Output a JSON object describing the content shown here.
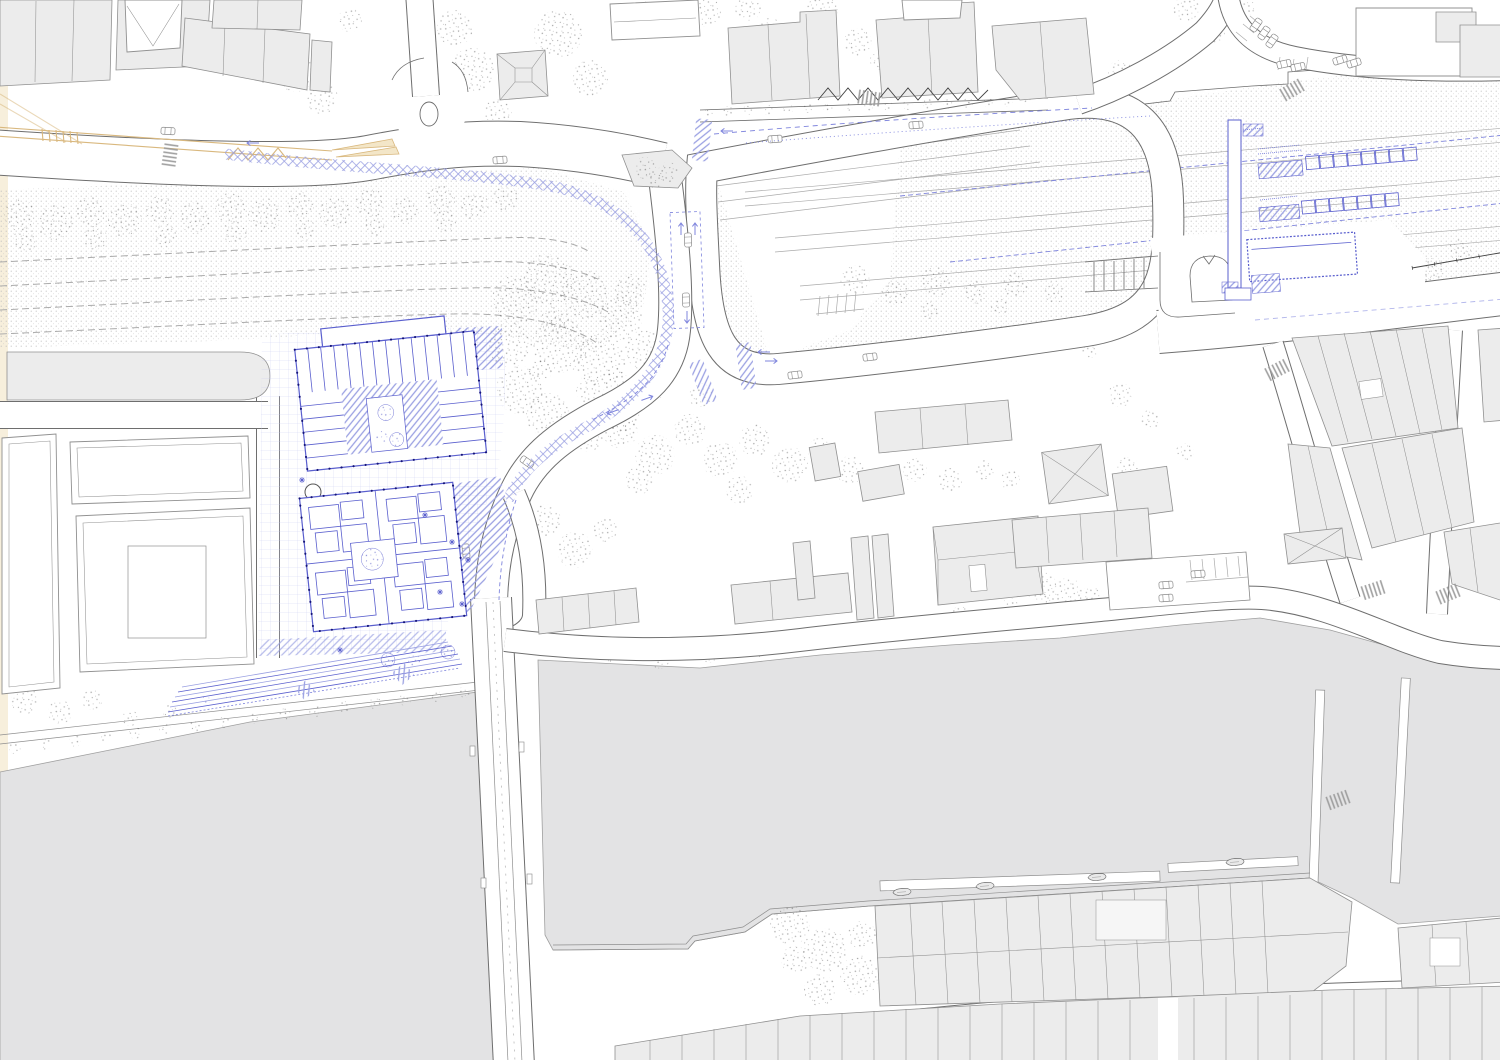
{
  "canvas": {
    "width": 1500,
    "height": 1060
  },
  "drawing": {
    "kind": "architectural site plan / urban masterplan",
    "view": "top-down technical plan drawing",
    "visible_text": "none"
  },
  "palette": {
    "paper": "#ffffff",
    "margin": "#f7efdc",
    "water": "#e3e3e4",
    "waterLine": "#9f9f9f",
    "bldgFill": "#ececec",
    "bldgLight": "#f5f5f5",
    "bldgLine": "#909090",
    "roadLine": "#6e6e6e",
    "railDot": "#bcbcbc",
    "trackLine": "#ababab",
    "treeInk": "#555555",
    "blueLine": "#5a5fce",
    "blueDark": "#15157a",
    "blueHatch": "#9aa0e2",
    "blueGrid": "#c9ccf0",
    "blueDash": "#7f85dd",
    "tan": "#d9b87e",
    "tanFill": "#f3e6c8",
    "carLine": "#8a8a8a",
    "darkLine": "#444444"
  },
  "features": {
    "water_bodies": {
      "count": 2,
      "names": [
        "river-west-basin",
        "river-east-basin"
      ],
      "color_key": "water"
    },
    "bridge": {
      "name": "road-bridge-over-river",
      "orientation": "north-south"
    },
    "railway_corridor": {
      "texture": "stipple-dots",
      "tracks_west": 4,
      "platform_lines_east": 6,
      "color_key": "railDot"
    },
    "roads": {
      "style": "white-with-gray-casing",
      "includes": [
        "top-boulevard",
        "rail-loop-ring",
        "east-station-road",
        "junction-connector",
        "bridge-street",
        "riverside-road",
        "old-town-diagonal",
        "old-town-vertical",
        "bottom-right-street",
        "northeast-branch",
        "top-right-road",
        "plaza-fork-road",
        "west-service-street",
        "west-cross-street"
      ]
    },
    "roundabout": {
      "island": "oval"
    },
    "existing_buildings": {
      "color_key": "bldgFill",
      "areas": [
        "top-left-block",
        "top-center-row",
        "left-courtyard-blocks",
        "mid-south-houses",
        "old-town-east",
        "bottom-right-bands",
        "riverfront-top-right"
      ]
    },
    "proposed_elements_blue": {
      "color_key": "blueLine",
      "items": [
        "plaza-paving-grid",
        "building-a-floor-plan",
        "building-b-floor-plan",
        "riverside-terraces",
        "station-platform-canopies",
        "station-access-bar",
        "station-building-dashed",
        "pedestrian-crossings",
        "cycle-path-hatch",
        "lane-markings",
        "courtyard-trees"
      ]
    },
    "vegetation": {
      "style": "stipple-clusters",
      "clusters": [
        "rail-tree-band",
        "central-grove",
        "south-band",
        "river-bank-rows",
        "scattered"
      ]
    },
    "tram": {
      "color_key": "tan",
      "name": "tram-tracks-with-switch-arrows"
    },
    "vehicles": {
      "cars": 20,
      "boats": 4
    },
    "street_furniture": [
      "zebra-crossings",
      "parking-stalls",
      "bike-rack-zigzag",
      "fence-ticks",
      "dock-boardwalk"
    ]
  }
}
